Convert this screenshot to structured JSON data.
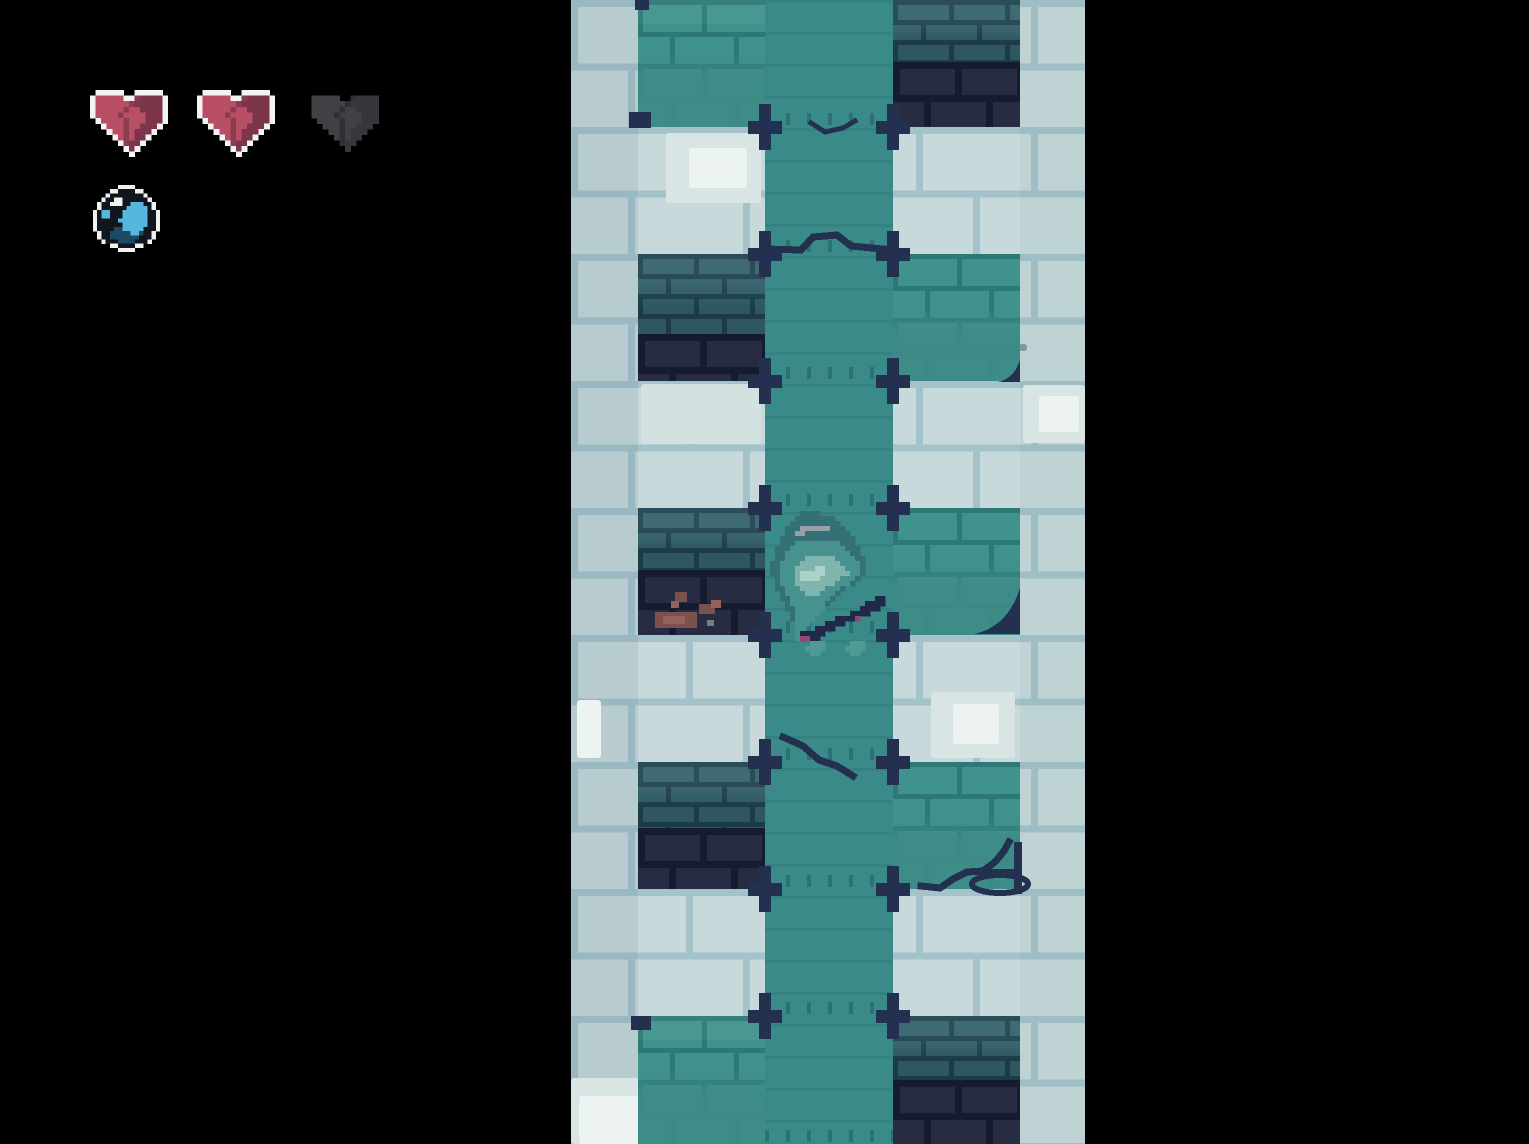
{
  "app": {
    "title": "pixel-dungeon-climb-screen"
  },
  "hud": {
    "health_current": 2,
    "health_max": 3,
    "hearts": [
      {
        "slot": 1,
        "state": "full"
      },
      {
        "slot": 2,
        "state": "full"
      },
      {
        "slot": 3,
        "state": "empty"
      }
    ],
    "hearts_layout": {
      "xs": [
        90,
        197,
        306
      ],
      "y": 90,
      "w": 78,
      "h": 67
    },
    "item": {
      "name": "orb-item",
      "x": 93,
      "y": 185,
      "size": 67
    }
  },
  "palette": {
    "bg": "#000000",
    "brick-fill": "#c7d9da",
    "brick-mortar": "#a4c2ca",
    "patch-hi": "#d8e5e4",
    "patch-hi2": "#d3e1e1",
    "patch-white": "#edf3f1",
    "patch-gray": "#7e99a0",
    "flow": "#398a89",
    "teal-fill": "#40928c",
    "teal-mortar": "#2d7975",
    "dteal-fill": "#33616b",
    "dteal-mortar": "#1e4250",
    "navy-fill": "#272c43",
    "navy-mortar": "#151b30",
    "cross": "#243050",
    "rust": "#7b5150",
    "rustHi": "#93625a",
    "grayChip": "#6e7f88",
    "heart-outline": "#f1f4f3",
    "heart-red": "#b94f64",
    "heart-shade": "#8c3c51",
    "heart-dark": "#7d3649",
    "heart-empty": "#414145",
    "heart-empty-shade": "#303034",
    "heart-empty-dark": "#37373b",
    "orb-ring": "#eef2f1",
    "orb-black": "#11151d",
    "orb-cyan": "#55b7dc",
    "orb-navy": "#1d4a63"
  },
  "scene": {
    "strip": {
      "x": 571,
      "width": 514,
      "height": 1144
    },
    "column": {
      "x": 194,
      "width": 128
    },
    "block_x": {
      "left": 67,
      "right": 322
    },
    "block_w": 127,
    "bands": [
      {
        "y": 0,
        "h": 127,
        "left": {
          "kind": "teal",
          "bright": true
        },
        "right": {
          "kind": "dark",
          "split": 0.49
        }
      },
      {
        "y": 127,
        "h": 127,
        "left": null,
        "right": null
      },
      {
        "y": 254,
        "h": 127,
        "left": {
          "kind": "dark",
          "split": 0.63
        },
        "right": {
          "kind": "teal"
        }
      },
      {
        "y": 381,
        "h": 127,
        "left": null,
        "right": null
      },
      {
        "y": 508,
        "h": 127,
        "left": {
          "kind": "dark",
          "split": 0.49
        },
        "right": {
          "kind": "teal"
        }
      },
      {
        "y": 635,
        "h": 127,
        "left": null,
        "right": null
      },
      {
        "y": 762,
        "h": 127,
        "left": {
          "kind": "dark",
          "split": 0.52
        },
        "right": {
          "kind": "teal"
        }
      },
      {
        "y": 889,
        "h": 127,
        "left": null,
        "right": null
      },
      {
        "y": 1016,
        "h": 128,
        "left": {
          "kind": "teal",
          "bright": true
        },
        "right": {
          "kind": "dark",
          "split": 0.5
        }
      }
    ],
    "cross_ys": [
      127,
      254,
      381,
      508,
      635,
      762,
      889,
      1016
    ],
    "cross_xs": [
      194,
      322
    ],
    "dash_extra_ys": [
      1144
    ],
    "patches": [
      [
        95,
        133,
        95,
        70,
        "patch-hi"
      ],
      [
        118,
        148,
        58,
        40,
        "patch-white"
      ],
      [
        70,
        384,
        120,
        60,
        "patch-hi2"
      ],
      [
        452,
        385,
        62,
        58,
        "patch-hi"
      ],
      [
        468,
        396,
        40,
        36,
        "patch-white"
      ],
      [
        360,
        692,
        84,
        66,
        "patch-hi"
      ],
      [
        382,
        704,
        46,
        40,
        "patch-white"
      ],
      [
        6,
        700,
        24,
        58,
        "patch-white"
      ],
      [
        0,
        1078,
        92,
        66,
        "patch-hi"
      ],
      [
        8,
        1096,
        60,
        48,
        "patch-white"
      ],
      [
        436,
        330,
        10,
        8,
        "patch-gray"
      ],
      [
        448,
        344,
        8,
        7,
        "patch-gray"
      ],
      [
        430,
        352,
        7,
        6,
        "patch-gray"
      ]
    ],
    "decals": {
      "polylines": [
        {
          "pts": [
            [
              194,
              249
            ],
            [
              230,
              250
            ],
            [
              242,
              237
            ],
            [
              266,
              235
            ],
            [
              280,
              246
            ],
            [
              322,
              250
            ]
          ],
          "w": 7
        },
        {
          "pts": [
            [
              240,
              123
            ],
            [
              254,
              132
            ],
            [
              272,
              128
            ],
            [
              284,
              121
            ]
          ],
          "w": 5
        },
        {
          "pts": [
            [
              212,
              737
            ],
            [
              232,
              746
            ],
            [
              248,
              760
            ],
            [
              266,
              766
            ],
            [
              282,
              776
            ]
          ],
          "w": 7
        },
        {
          "pts": [
            [
              350,
              886
            ],
            [
              369,
              888
            ],
            [
              382,
              879
            ],
            [
              396,
              872
            ],
            [
              412,
              871
            ],
            [
              424,
              862
            ],
            [
              433,
              851
            ],
            [
              438,
              842
            ]
          ],
          "w": 7
        }
      ],
      "rects": [
        [
          394,
          869,
          54,
          6
        ],
        [
          443,
          842,
          8,
          52
        ],
        [
          64,
          0,
          14,
          10
        ],
        [
          58,
          112,
          22,
          16
        ],
        [
          60,
          1016,
          20,
          14
        ]
      ],
      "ellipses": [
        {
          "cx": 429,
          "cy": 884,
          "rx": 28,
          "ry": 9,
          "w": 6
        }
      ],
      "corners": [
        {
          "x": 449,
          "y": 588,
          "s": 46
        },
        {
          "x": 449,
          "y": 360,
          "s": 22
        }
      ],
      "debris": [
        [
          84,
          612,
          42,
          16,
          "rust"
        ],
        [
          92,
          616,
          22,
          8,
          "rustHi"
        ],
        [
          104,
          592,
          12,
          10,
          "rust"
        ],
        [
          100,
          601,
          8,
          7,
          "rustHi"
        ],
        [
          128,
          604,
          16,
          10,
          "rust"
        ],
        [
          140,
          600,
          10,
          8,
          "rustHi"
        ],
        [
          136,
          620,
          7,
          6,
          "grayChip"
        ]
      ]
    }
  },
  "character": {
    "x": 199,
    "y": 506,
    "cell": 5,
    "palette": {
      "h": "#337176",
      "b": "#47918e",
      "l": "#7fb5ad",
      "L": "#abd1c8",
      "g": "#99a0aa",
      "n": "#20294a",
      "m": "#8f4a72",
      "f": "#4f9a93"
    },
    "rows": [
      ".........................",
      "......hhhh...............",
      ".....hhhhhhhh............",
      "....hhhhhhhhhh...........",
      "...hhhgggggghhh..........",
      "...hhgghhhhhhhhh.........",
      "..hhhhhhhhhhhhhhh........",
      "..hhhbbbbbbbbbhhh........",
      ".hhhbbbbbbbbbbbhhh.......",
      ".hhbbbbbbbbbbbbbhh.......",
      ".hhbbbbllllllbbbbhh......",
      "hhbbbbllllllllbbbbh......",
      "hhbbbllllLLllllbbbh......",
      "hhbbblLLLLLlllllbbh......",
      ".hbbblLLLLllllbbbh.......",
      ".hbbbllllllllbbbh........",
      ".hhbbblllllbbbh..........",
      "..hbbbblllbbbh...........",
      "..hhbbbbbbbbh........nn..",
      "...hbbbbbbbh.......nnnn..",
      "...hhbbbbbb.......nnnn...",
      "....hbbbbb......nnnn.....",
      "....hbbbb....nnnnm.......",
      ".....bbb...nnnn..........",
      ".....bb..nnnn............",
      ".....bnnnnn..............",
      ".....bmmnn...............",
      "........fff.....fff......",
      ".......ffff....ffff......",
      "........ff......ff......."
    ]
  },
  "pixel_art": {
    "heart_rows": [
      ".WWWWW..WWWWW.",
      "WrrrrrWWsddddW",
      "WrrrrrrsdddddW",
      "WrrrrrsrrddddW",
      "WrrrrsrrrrdddW",
      ".WrrrrsrrrdddW",
      "..WrrrsrrdddW.",
      "...WrrsrdddW..",
      "....WrsrddW...",
      ".....WsddW....",
      "......WdW.....",
      ".......W......"
    ],
    "heart_palettes": {
      "full": {
        "W": "heart-outline",
        "r": "heart-red",
        "s": "heart-shade",
        "d": "heart-dark"
      },
      "empty": {
        "W": null,
        "r": "heart-empty",
        "s": "heart-empty-shade",
        "d": "heart-empty-dark"
      }
    },
    "orb_rows": [
      "......WWWW......",
      "....WWkkkkWW....",
      "...WkkkkkkkkW...",
      "..WkkWWkkkkkkW..",
      ".WkkWWWkkccckkW.",
      ".WkkkkkkccccckW.",
      "WkcckkkcccccckkW",
      "WkcckkkcccccckkW",
      "WkkkkkccccccckkW",
      "WkkkkkkcccccckkW",
      "WkkkknnccccckkkW",
      ".WkknnnnnccnkkW.",
      ".WkknnnnnnnkkkW.",
      "..WkkknnnnkkkW..",
      "....WWkkkkWW....",
      "......WWWW......"
    ],
    "orb_palette": {
      "W": "orb-ring",
      "k": "orb-black",
      "c": "orb-cyan",
      "n": "orb-navy"
    }
  }
}
